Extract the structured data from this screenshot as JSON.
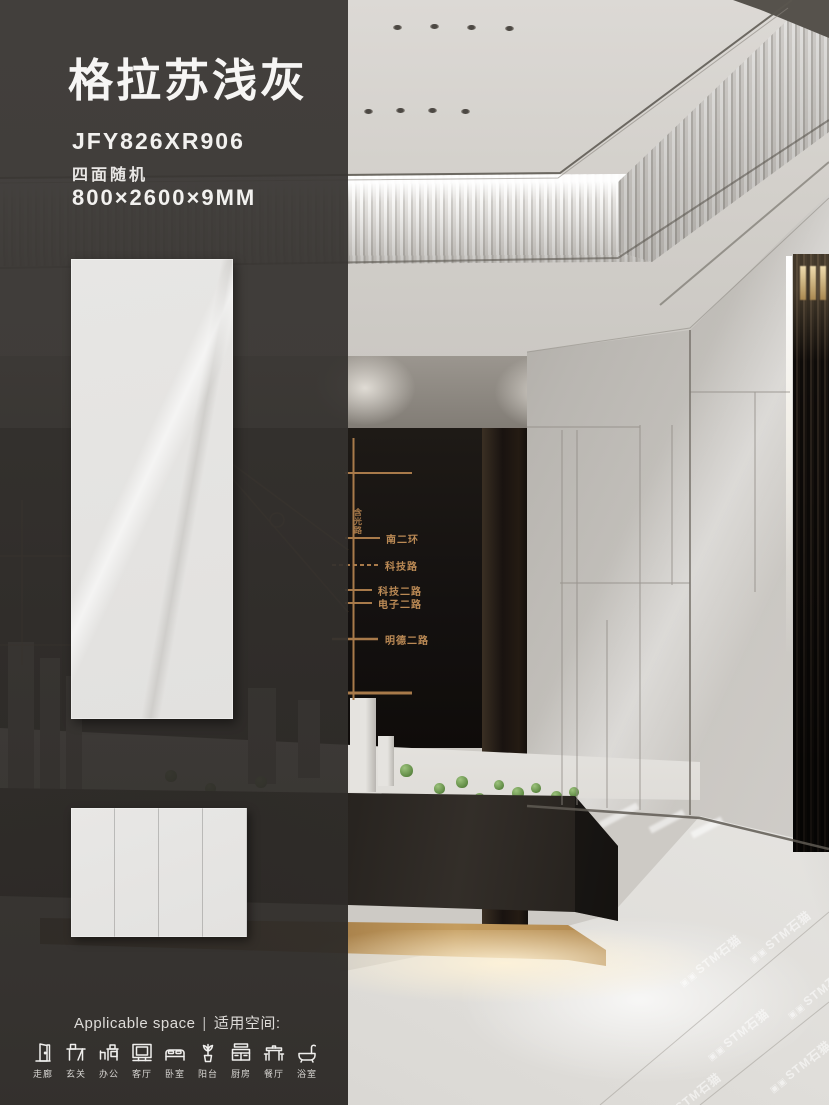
{
  "poster": {
    "title": "格拉苏浅灰",
    "product_code": "JFY826XR906",
    "surface_note": "四面随机",
    "dimensions": "800×2600×9MM"
  },
  "applicable_space": {
    "label_en": "Applicable space",
    "separator": "|",
    "label_zh": "适用空间:",
    "spaces": [
      {
        "label": "走廊",
        "icon": "corridor-door-icon"
      },
      {
        "label": "玄关",
        "icon": "entry-console-icon"
      },
      {
        "label": "办公",
        "icon": "office-desk-icon"
      },
      {
        "label": "客厅",
        "icon": "living-room-tv-icon"
      },
      {
        "label": "卧室",
        "icon": "bedroom-bed-icon"
      },
      {
        "label": "阳台",
        "icon": "balcony-plant-icon"
      },
      {
        "label": "厨房",
        "icon": "kitchen-cabinet-icon"
      },
      {
        "label": "餐厅",
        "icon": "dining-table-icon"
      },
      {
        "label": "浴室",
        "icon": "bathtub-icon"
      }
    ]
  },
  "scene_map_wall": {
    "road_labels": [
      "南二环",
      "科技路",
      "科技二路",
      "电子二路",
      "明德二路"
    ],
    "vertical_road_label": "含光路",
    "line_color": "#b5804e"
  },
  "watermark": {
    "logo_glyph": "▣▣",
    "text": "STM石猫"
  },
  "colors": {
    "overlay_panel": "#35322f",
    "title_text": "#f6f5f4",
    "tile_surface": "#e5e4e2",
    "map_copper": "#b5804e",
    "gold_band": "#c49c5e",
    "floor": "#e8e7e4",
    "ceiling": "#d6d3cf"
  }
}
